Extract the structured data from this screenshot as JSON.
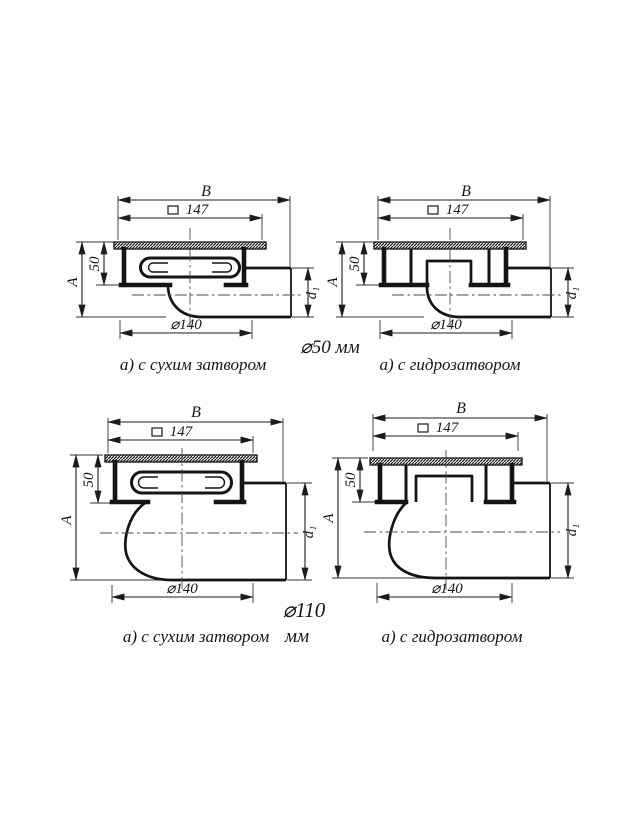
{
  "drawing": {
    "background": "#ffffff",
    "line_color": "#1c1c1c",
    "group_labels": {
      "top": "⌀50 мм",
      "bottom_line1": "⌀110",
      "bottom_line2": "мм"
    },
    "figures": {
      "top_left": {
        "caption": "а) с сухим затвором",
        "dims": {
          "overall_width": "B",
          "square_size": "147",
          "grate_depth": "50",
          "overall_height": "A",
          "outlet_diameter": "d₁",
          "bowl_diameter": "⌀140"
        }
      },
      "top_right": {
        "caption": "а) с гидрозатвором",
        "dims": {
          "overall_width": "B",
          "square_size": "147",
          "grate_depth": "50",
          "overall_height": "A",
          "outlet_diameter": "d₁",
          "bowl_diameter": "⌀140"
        }
      },
      "bottom_left": {
        "caption": "а) с сухим затвором",
        "dims": {
          "overall_width": "B",
          "square_size": "147",
          "grate_depth": "50",
          "overall_height": "A",
          "outlet_diameter": "d₁",
          "bowl_diameter": "⌀140"
        }
      },
      "bottom_right": {
        "caption": "а) с гидрозатвором",
        "dims": {
          "overall_width": "B",
          "square_size": "147",
          "grate_depth": "50",
          "overall_height": "A",
          "outlet_diameter": "d₁",
          "bowl_diameter": "⌀140"
        }
      }
    }
  }
}
